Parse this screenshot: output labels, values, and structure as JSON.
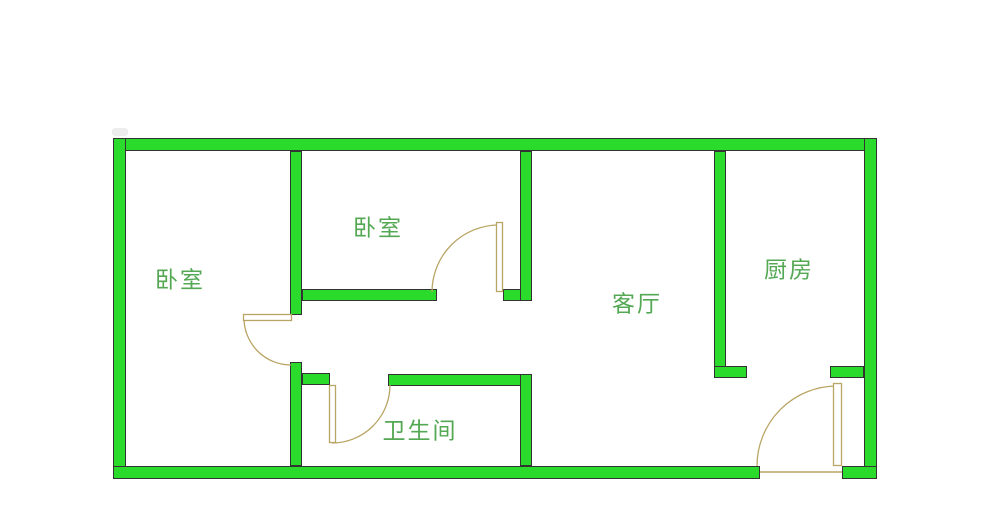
{
  "colors": {
    "background": "#ffffff",
    "wall_fill": "#2bdb2b",
    "wall_outline": "#333333",
    "door": "#b9a564",
    "door_leaf_fill": "#ffffff",
    "label_text": "#54a854",
    "smudge": "#e6e6e6"
  },
  "rooms": [
    {
      "id": "bedroom-1",
      "label": "卧室",
      "cx": 180,
      "cy": 281
    },
    {
      "id": "bedroom-2",
      "label": "卧室",
      "cx": 378,
      "cy": 229
    },
    {
      "id": "living-room",
      "label": "客厅",
      "cx": 637,
      "cy": 305
    },
    {
      "id": "kitchen",
      "label": "厨房",
      "cx": 789,
      "cy": 271
    },
    {
      "id": "bathroom",
      "label": "卫生间",
      "cx": 420,
      "cy": 432
    }
  ],
  "floorplan": {
    "walls": [
      {
        "name": "wall-outer-top",
        "rect": [
          113,
          138,
          764,
          13
        ]
      },
      {
        "name": "wall-outer-left",
        "rect": [
          113,
          138,
          13,
          341
        ]
      },
      {
        "name": "wall-outer-right",
        "rect": [
          864,
          138,
          13,
          341
        ]
      },
      {
        "name": "wall-outer-bottom-left",
        "rect": [
          113,
          466,
          647,
          13
        ]
      },
      {
        "name": "wall-outer-bottom-right",
        "rect": [
          842,
          466,
          35,
          13
        ]
      },
      {
        "name": "wall-bedroom1-right-upper",
        "rect": [
          290,
          151,
          12,
          164
        ]
      },
      {
        "name": "wall-bedroom1-right-lower",
        "rect": [
          290,
          362,
          12,
          104
        ]
      },
      {
        "name": "wall-bedroom2-bottom-left",
        "rect": [
          302,
          289,
          135,
          12
        ]
      },
      {
        "name": "wall-bedroom2-bottom-right",
        "rect": [
          503,
          289,
          29,
          12
        ]
      },
      {
        "name": "wall-bedroom2-living",
        "rect": [
          520,
          151,
          12,
          150
        ]
      },
      {
        "name": "wall-bathroom-top-stub",
        "rect": [
          302,
          373,
          28,
          12
        ]
      },
      {
        "name": "wall-bathroom-top",
        "rect": [
          388,
          374,
          144,
          12
        ]
      },
      {
        "name": "wall-bathroom-right",
        "rect": [
          520,
          374,
          12,
          92
        ]
      },
      {
        "name": "wall-living-kitchen",
        "rect": [
          714,
          151,
          12,
          227
        ]
      },
      {
        "name": "wall-kitchen-bottom-left",
        "rect": [
          714,
          366,
          33,
          12
        ]
      },
      {
        "name": "wall-kitchen-bottom-right",
        "rect": [
          830,
          366,
          34,
          12
        ]
      }
    ],
    "doors": [
      {
        "name": "door-bedroom-1",
        "leaf": [
          243,
          314,
          49,
          7
        ],
        "arc": "M244,318 A47,47 0 0 0 291,365"
      },
      {
        "name": "door-bedroom-2",
        "leaf": [
          496,
          222,
          7,
          70
        ],
        "arc": "M499,225 A67,67 0 0 0 432,292"
      },
      {
        "name": "door-bathroom",
        "leaf": [
          329,
          385,
          7,
          58
        ],
        "arc": "M332,443 A58,58 0 0 0 390,385"
      },
      {
        "name": "door-entrance",
        "leaf": [
          833,
          383,
          9,
          83
        ],
        "arc": "M837,386 A80,80 0 0 0 757,466"
      }
    ],
    "threshold": {
      "name": "entrance-threshold",
      "line": [
        760,
        472,
        842,
        472
      ]
    },
    "smudge": {
      "name": "corner-smudge",
      "rect": [
        112,
        128,
        16,
        8
      ]
    }
  }
}
